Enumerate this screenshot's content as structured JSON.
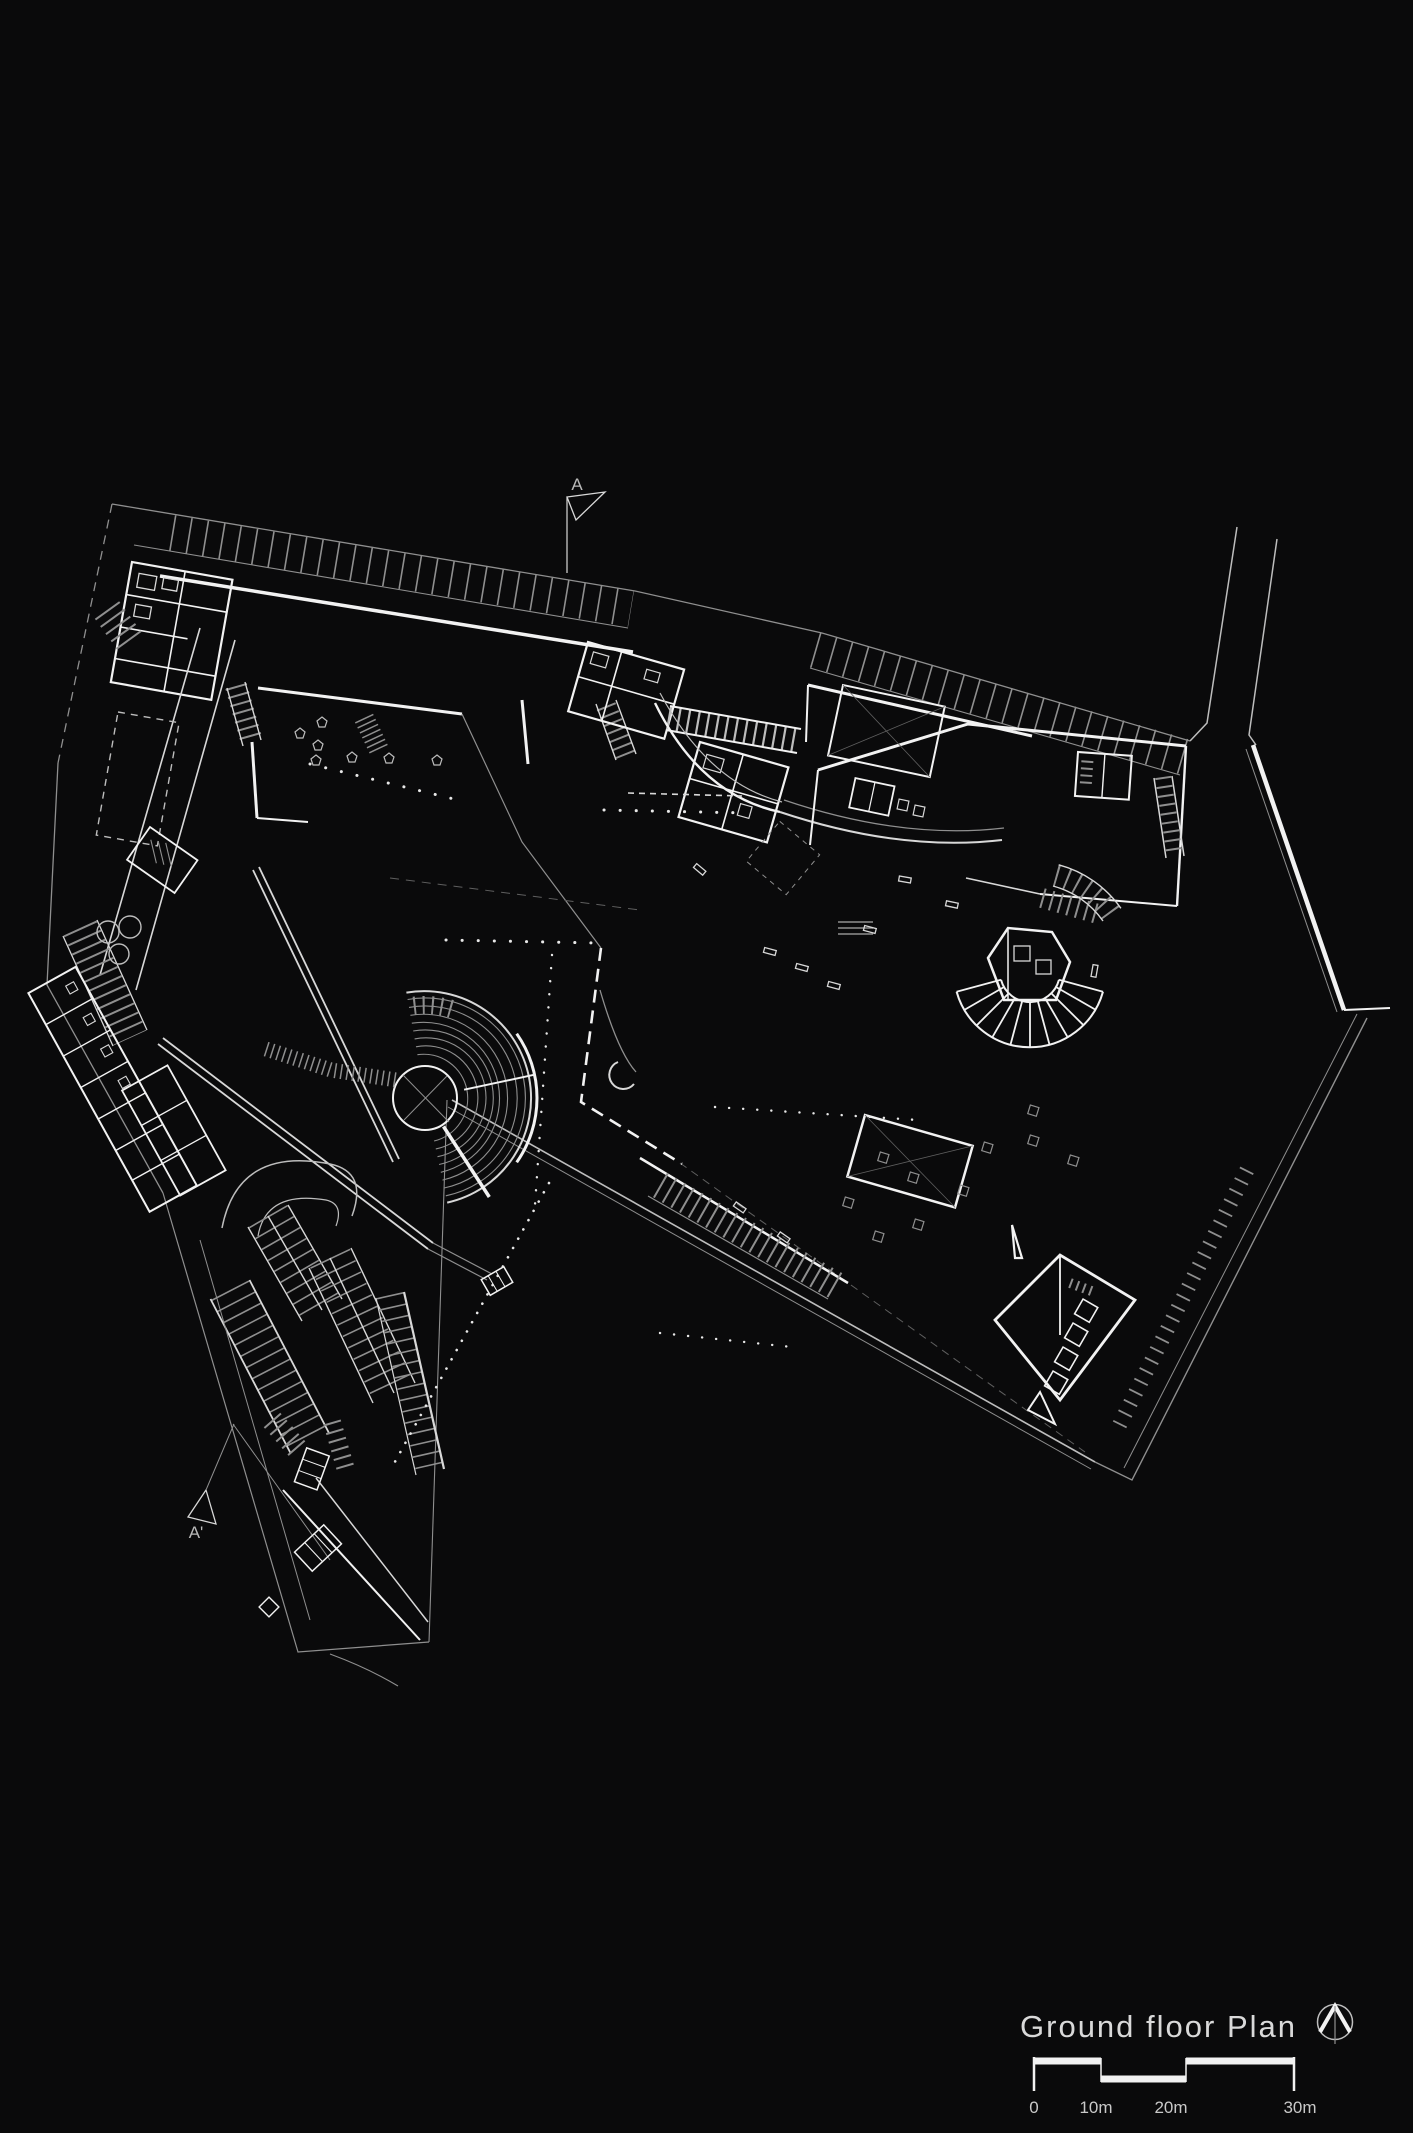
{
  "page": {
    "background_color": "#0a0a0b"
  },
  "plan": {
    "title": "Ground floor Plan",
    "section_markers": {
      "top": "A",
      "bottom": "A'"
    },
    "scale_bar": {
      "labels": [
        "0",
        "10m",
        "20m",
        "30m"
      ]
    },
    "colors": {
      "background": "#0a0a0b",
      "wall_bright": "#f2f2f2",
      "line_medium": "#bdbdbd",
      "line_faint": "#8f8f8f",
      "text": "#cfcfcf"
    },
    "icons": {
      "north_arrow": "north-arrow-icon"
    }
  }
}
